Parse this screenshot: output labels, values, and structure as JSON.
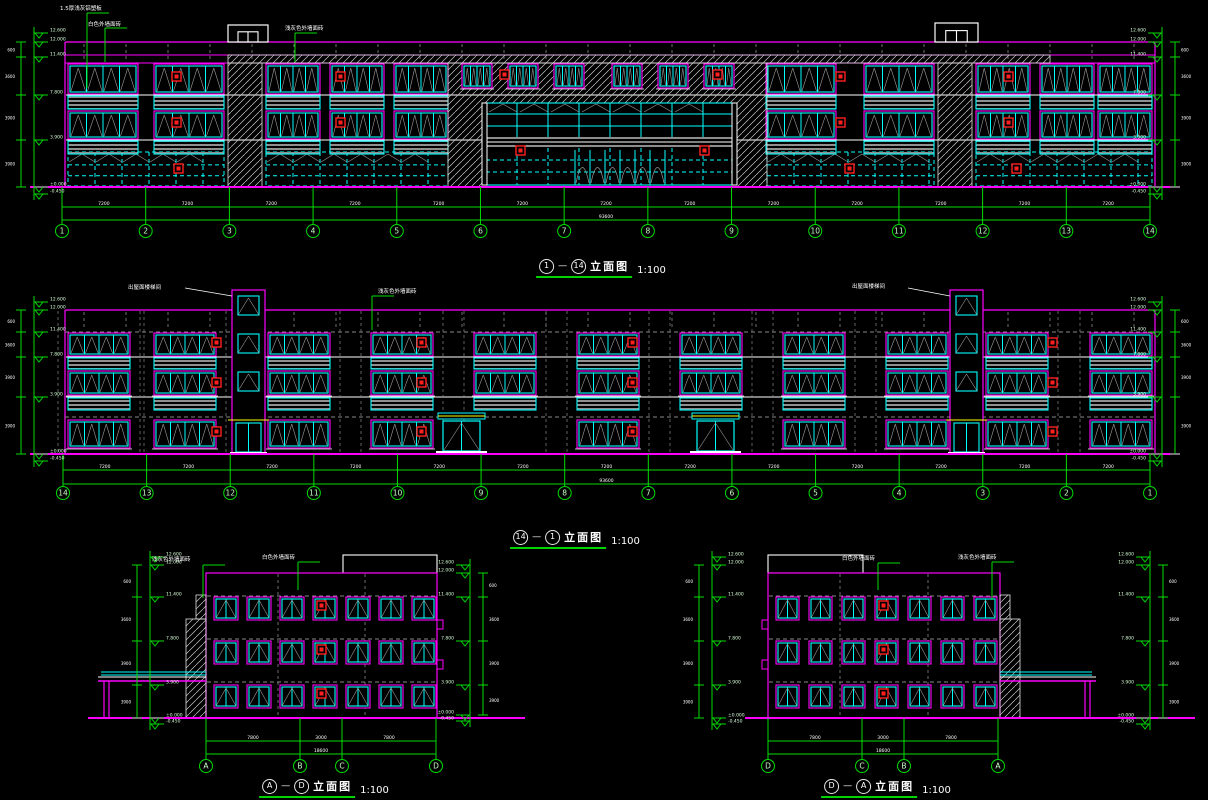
{
  "drawing": {
    "type": "architectural-elevations",
    "scale_note": "1:100"
  },
  "titles": {
    "elev1": {
      "from": "1",
      "to": "14",
      "caption": "立面图",
      "scale": "1:100"
    },
    "elev2": {
      "from": "14",
      "to": "1",
      "caption": "立面图",
      "scale": "1:100"
    },
    "elev3": {
      "from": "A",
      "to": "D",
      "caption": "立面图",
      "scale": "1:100"
    },
    "elev4": {
      "from": "D",
      "to": "A",
      "caption": "立面图",
      "scale": "1:100"
    }
  },
  "axes": {
    "elev1": [
      "1",
      "2",
      "3",
      "4",
      "5",
      "6",
      "7",
      "8",
      "9",
      "10",
      "11",
      "12",
      "13",
      "14"
    ],
    "elev2": [
      "14",
      "13",
      "12",
      "11",
      "10",
      "9",
      "8",
      "7",
      "6",
      "5",
      "4",
      "3",
      "2",
      "1"
    ],
    "elev3": [
      "A",
      "B",
      "C",
      "D"
    ],
    "elev4": [
      "D",
      "C",
      "B",
      "A"
    ]
  },
  "dimensions": {
    "elev1_bays": [
      "7200",
      "7200",
      "7200",
      "7200",
      "7200",
      "7200",
      "7200",
      "7200",
      "7200",
      "7200",
      "7200",
      "7200",
      "7200"
    ],
    "elev1_total": "93600",
    "elev2_bays": [
      "7200",
      "7200",
      "7200",
      "7200",
      "7200",
      "7200",
      "7200",
      "7200",
      "7200",
      "7200",
      "7200",
      "7200",
      "7200"
    ],
    "elev2_total": "93600",
    "elev34_bays": [
      "7800",
      "3000",
      "7800"
    ],
    "elev34_total": "18600"
  },
  "levels": [
    "12.600",
    "12.000",
    "11.400",
    "7.800",
    "3.900",
    "±0.000",
    "-0.450"
  ],
  "floor_heights": [
    "600",
    "3600",
    "3900",
    "3900",
    "450"
  ],
  "annotations": {
    "elev1": [
      "1.5厚浅灰铝塑板",
      "白色外墙面砖",
      "浅灰色外墙面砖"
    ],
    "elev2_green": [
      "浅灰色外墙面砖"
    ],
    "elev2_white": [
      "出屋面楼梯间",
      "出屋面楼梯间"
    ],
    "elev3": [
      "浅灰色外墙面砖",
      "白色外墙面砖"
    ],
    "elev4": [
      "白色外墙面砖",
      "浅灰色外墙面砖"
    ]
  },
  "colors": {
    "magenta": "#ff00ff",
    "cyan": "#00ffff",
    "green": "#00dd00",
    "white": "#ffffff",
    "gray": "#9a9a9a",
    "red": "#ff1f1f",
    "axis_text": "#c8ffc8",
    "level_text": "#d8ffd8",
    "yellow": "#ffff00"
  }
}
